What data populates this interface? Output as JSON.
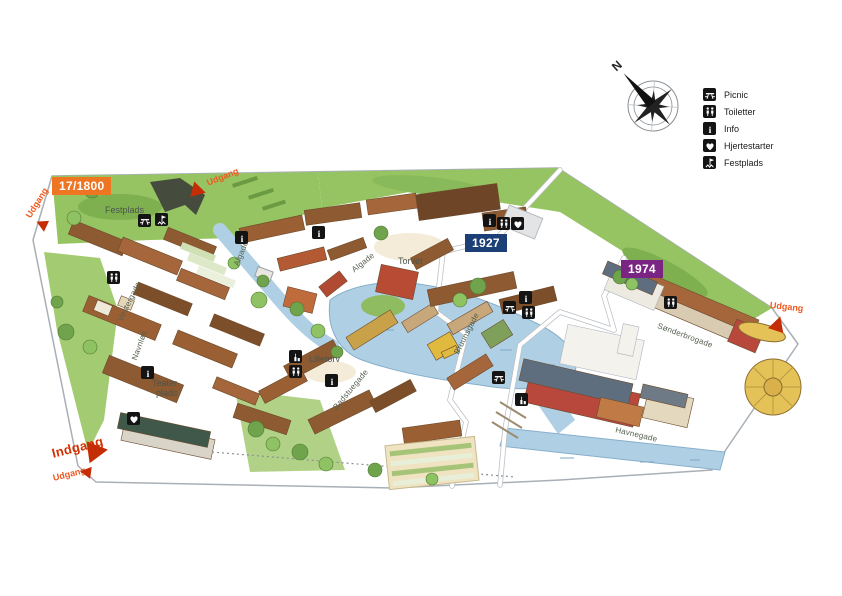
{
  "legend": {
    "items": [
      {
        "icon": "picnic-icon",
        "label": "Picnic"
      },
      {
        "icon": "toilets-icon",
        "label": "Toiletter"
      },
      {
        "icon": "info-icon",
        "label": "Info"
      },
      {
        "icon": "heart-icon",
        "label": "Hjertestarter"
      },
      {
        "icon": "festplads-icon",
        "label": "Festplads"
      }
    ]
  },
  "compass": {
    "north": "N"
  },
  "eras": {
    "e1800": {
      "label": "17/1800",
      "color": "#EE7623"
    },
    "e1927": {
      "label": "1927",
      "color": "#1C3F77"
    },
    "e1974": {
      "label": "1974",
      "color": "#7A2583"
    }
  },
  "gates": {
    "entrance": "Indgang",
    "exit": "Udgang"
  },
  "places": {
    "festplads": "Festplads",
    "torvet": "Torvet",
    "lilletorv": "Lilletorv",
    "teaterplads_line1": "Teater-",
    "teaterplads_line2": "plads"
  },
  "streets": {
    "algade": "Algade",
    "vestergade": "Vestergade",
    "navnlos": "Navnløs",
    "bruunsgade": "Bruunsgade",
    "badstuegade": "Badstuegade",
    "sonderbrogade": "Sønderbrogade",
    "havnegade": "Havnegade"
  },
  "colors": {
    "exit_red": "#EF5A1F",
    "entrance_red": "#D33000",
    "arrow_red": "#C42D05",
    "map_green": "#97C462",
    "water_blue": "#AFD0E4"
  }
}
